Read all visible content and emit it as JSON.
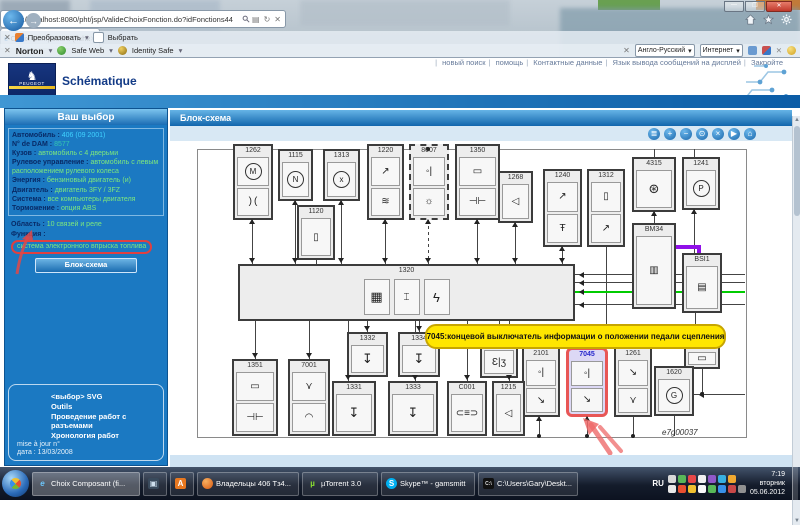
{
  "browser": {
    "url": "http://localhost:8080/pht/jsp/ValideChoixFonction.do?idFonctions44",
    "tab_title": "Choix Composant (fichier)",
    "command_bar": {
      "convert_label": "Преобразовать",
      "select_label": "Выбрать"
    },
    "norton": {
      "brand": "Norton",
      "safe_web": "Safe Web",
      "identity_safe": "Identity Safe"
    },
    "lang_dropdown": "Англо-Русский",
    "zone_dropdown": "Интернет"
  },
  "page": {
    "nav_links": [
      "новый поиск",
      "помощь",
      "Контактные данные",
      "Язык вывода сообщений на дисплей",
      "Закройте"
    ],
    "brand": {
      "logo_text": "PEUGEOT",
      "app_title": "Schématique"
    },
    "sidebar": {
      "title": "Ваш выбор",
      "vehicle": [
        {
          "label": "Автомобиль",
          "value": "406 (09 2001)",
          "color": "#3fd2ff"
        },
        {
          "label": "N° de DAM",
          "value": "8577",
          "color": "#35c8b0"
        },
        {
          "label": "Кузов",
          "value": "автомобиль с 4 дверьми"
        },
        {
          "label": "Рулевое управление",
          "value": "автомобиль с левым расположением рулевого колеса"
        },
        {
          "label": "Энергия",
          "value": "бензиновый двигатель (и)"
        },
        {
          "label": "Двигатель",
          "value": "двигатель 3FY / 3FZ"
        },
        {
          "label": "Система",
          "value": "все компьютеры двигателя"
        },
        {
          "label": "Торможение",
          "value": "опция ABS"
        }
      ],
      "selection": [
        {
          "label": "Область",
          "value": "10 связей и реле"
        },
        {
          "label": "Функция",
          "value": "система электронного впрыска топлива",
          "highlighted": true
        }
      ],
      "button": "Блок-схема",
      "footer_links": [
        "<выбор> SVG",
        "Outils",
        "Проведение работ с разъемами",
        "Хронология работ"
      ],
      "footer_meta": [
        "mise à jour n°",
        "дата : 13/03/2008"
      ]
    },
    "main": {
      "header": "Блок-схема",
      "toolbar_icons": [
        "print",
        "zoom-in",
        "zoom-out",
        "magnifier",
        "close",
        "play",
        "home"
      ],
      "diagram": {
        "ref": "e7g00037",
        "tooltip": "7045:концевой выключатель информации о положении педали сцепления",
        "accent_colors": {
          "highlight_border": "#e85656",
          "tooltip_bg": "#ffe600",
          "green_wire": "#00cc00",
          "purple_wire": "#9010e8"
        },
        "frame": {
          "x": 27,
          "y": 8,
          "w": 548,
          "h": 287
        },
        "boxes": [
          {
            "id": "1262",
            "x": 63,
            "y": 3,
            "w": 40,
            "h": 76,
            "cells": [
              "motor",
              "throttle"
            ]
          },
          {
            "id": "1115",
            "x": 108,
            "y": 8,
            "w": 35,
            "h": 52,
            "cells": [
              "circleN"
            ]
          },
          {
            "id": "1313",
            "x": 153,
            "y": 8,
            "w": 37,
            "h": 52,
            "cells": [
              "circleX"
            ]
          },
          {
            "id": "1120",
            "x": 127,
            "y": 64,
            "w": 38,
            "h": 55,
            "cells": [
              "piston"
            ]
          },
          {
            "id": "1220",
            "x": 197,
            "y": 3,
            "w": 37,
            "h": 76,
            "cells": [
              "flap",
              "temp"
            ]
          },
          {
            "id": "8007",
            "x": 239,
            "y": 3,
            "w": 40,
            "h": 76,
            "cells": [
              "contact",
              "sun"
            ],
            "dashed": true
          },
          {
            "id": "1350",
            "x": 285,
            "y": 3,
            "w": 45,
            "h": 76,
            "cells": [
              "resistor",
              "capacitor"
            ]
          },
          {
            "id": "1268",
            "x": 328,
            "y": 30,
            "w": 35,
            "h": 52,
            "cells": [
              "diode"
            ]
          },
          {
            "id": "1240",
            "x": 373,
            "y": 28,
            "w": 39,
            "h": 78,
            "cells": [
              "flap",
              "tempkey"
            ]
          },
          {
            "id": "1312",
            "x": 417,
            "y": 28,
            "w": 38,
            "h": 78,
            "cells": [
              "piston",
              "flap"
            ]
          },
          {
            "id": "4315",
            "x": 462,
            "y": 16,
            "w": 44,
            "h": 55,
            "cells": [
              "fan"
            ]
          },
          {
            "id": "1241",
            "x": 512,
            "y": 16,
            "w": 38,
            "h": 53,
            "cells": [
              "circleP"
            ]
          },
          {
            "id": "BM34",
            "x": 462,
            "y": 82,
            "w": 44,
            "h": 86,
            "cells": [
              "ecu"
            ]
          },
          {
            "id": "BSI1",
            "x": 512,
            "y": 112,
            "w": 40,
            "h": 60,
            "cells": [
              "ecu2"
            ]
          },
          {
            "id": "1273",
            "x": 514,
            "y": 198,
            "w": 36,
            "h": 30,
            "cells": [
              "mini"
            ]
          },
          {
            "id": "1320",
            "x": 68,
            "y": 123,
            "w": 337,
            "h": 57,
            "cells": [
              "chip",
              "spark",
              "lightning"
            ],
            "wide": true
          },
          {
            "id": "1332",
            "x": 177,
            "y": 191,
            "w": 41,
            "h": 45,
            "cells": [
              "injector"
            ]
          },
          {
            "id": "1334",
            "x": 228,
            "y": 191,
            "w": 42,
            "h": 45,
            "cells": [
              "injector"
            ]
          },
          {
            "id": "coil",
            "x": 310,
            "y": 205,
            "w": 38,
            "h": 32,
            "cells": [
              "coil"
            ],
            "nolabel": true
          },
          {
            "id": "2101",
            "x": 352,
            "y": 206,
            "w": 38,
            "h": 70,
            "cells": [
              "contact",
              "switch"
            ]
          },
          {
            "id": "7045",
            "x": 396,
            "y": 206,
            "w": 42,
            "h": 70,
            "cells": [
              "contact",
              "switch"
            ],
            "hl": true
          },
          {
            "id": "1261",
            "x": 444,
            "y": 206,
            "w": 38,
            "h": 70,
            "cells": [
              "switch",
              "wye"
            ]
          },
          {
            "id": "1620",
            "x": 484,
            "y": 225,
            "w": 40,
            "h": 50,
            "cells": [
              "circleG"
            ]
          },
          {
            "id": "1351",
            "x": 62,
            "y": 218,
            "w": 46,
            "h": 77,
            "cells": [
              "resistor",
              "capacitor"
            ]
          },
          {
            "id": "7001",
            "x": 118,
            "y": 218,
            "w": 42,
            "h": 77,
            "cells": [
              "wye",
              "gauge"
            ]
          },
          {
            "id": "1331",
            "x": 162,
            "y": 240,
            "w": 44,
            "h": 55,
            "cells": [
              "injector"
            ]
          },
          {
            "id": "1333",
            "x": 218,
            "y": 240,
            "w": 50,
            "h": 55,
            "cells": [
              "injector"
            ]
          },
          {
            "id": "C001",
            "x": 277,
            "y": 240,
            "w": 40,
            "h": 55,
            "cells": [
              "connector"
            ]
          },
          {
            "id": "1215",
            "x": 322,
            "y": 240,
            "w": 33,
            "h": 55,
            "cells": [
              "diode"
            ]
          }
        ],
        "lines": [
          {
            "x": 82,
            "y": 79,
            "h": 44
          },
          {
            "x": 125,
            "y": 60,
            "h": 63
          },
          {
            "x": 171,
            "y": 60,
            "h": 63
          },
          {
            "x": 146,
            "y": 119,
            "h": 4
          },
          {
            "x": 215,
            "y": 79,
            "h": 44
          },
          {
            "x": 258,
            "y": 79,
            "h": 44,
            "dash": true
          },
          {
            "x": 307,
            "y": 79,
            "h": 44
          },
          {
            "x": 345,
            "y": 82,
            "h": 41
          },
          {
            "x": 392,
            "y": 106,
            "h": 17
          },
          {
            "x": 436,
            "y": 106,
            "h": 84
          },
          {
            "x": 85,
            "y": 180,
            "h": 38
          },
          {
            "x": 139,
            "y": 180,
            "h": 38
          },
          {
            "x": 178,
            "y": 180,
            "h": 60
          },
          {
            "x": 197,
            "y": 180,
            "h": 11
          },
          {
            "x": 245,
            "y": 180,
            "h": 60
          },
          {
            "x": 249,
            "y": 180,
            "h": 11
          },
          {
            "x": 297,
            "y": 180,
            "h": 60
          },
          {
            "x": 339,
            "y": 180,
            "h": 60
          },
          {
            "x": 329,
            "y": 180,
            "h": 25
          },
          {
            "x": 484,
            "y": 71,
            "h": 11
          },
          {
            "x": 524,
            "y": 69,
            "h": 43
          },
          {
            "x": 525,
            "y": 172,
            "h": 26
          },
          {
            "x": 405,
            "y": 133,
            "w": 170
          },
          {
            "x": 405,
            "y": 141,
            "w": 170
          },
          {
            "x": 405,
            "y": 150,
            "w": 170,
            "color": "#00cc00",
            "th": 2
          },
          {
            "x": 405,
            "y": 163,
            "w": 170
          },
          {
            "x": 506,
            "y": 104,
            "w": 24,
            "color": "#9010e8",
            "th": 4
          },
          {
            "x": 527,
            "y": 104,
            "h": 10,
            "color": "#9010e8",
            "th": 4
          },
          {
            "x": 369,
            "y": 276,
            "h": 19
          },
          {
            "x": 417,
            "y": 276,
            "h": 19
          },
          {
            "x": 463,
            "y": 276,
            "h": 19
          },
          {
            "x": 504,
            "y": 275,
            "h": 20
          },
          {
            "x": 524,
            "y": 253,
            "w": 51
          },
          {
            "x": 532,
            "y": 228,
            "h": 25
          },
          {
            "x": 484,
            "y": 8,
            "h": 8
          },
          {
            "x": 524,
            "y": 8,
            "h": 8
          }
        ],
        "arrows": [
          {
            "d": "down",
            "x": 82,
            "y": 117
          },
          {
            "d": "down",
            "x": 125,
            "y": 117
          },
          {
            "d": "down",
            "x": 171,
            "y": 117
          },
          {
            "d": "down",
            "x": 215,
            "y": 117
          },
          {
            "d": "down",
            "x": 258,
            "y": 117
          },
          {
            "d": "down",
            "x": 307,
            "y": 117
          },
          {
            "d": "down",
            "x": 345,
            "y": 117
          },
          {
            "d": "down",
            "x": 392,
            "y": 117
          },
          {
            "d": "up",
            "x": 82,
            "y": 80
          },
          {
            "d": "up",
            "x": 125,
            "y": 61
          },
          {
            "d": "up",
            "x": 171,
            "y": 61
          },
          {
            "d": "up",
            "x": 215,
            "y": 80
          },
          {
            "d": "up",
            "x": 258,
            "y": 80
          },
          {
            "d": "up",
            "x": 307,
            "y": 80
          },
          {
            "d": "up",
            "x": 345,
            "y": 83
          },
          {
            "d": "up",
            "x": 392,
            "y": 107
          },
          {
            "d": "down",
            "x": 85,
            "y": 212
          },
          {
            "d": "down",
            "x": 139,
            "y": 212
          },
          {
            "d": "down",
            "x": 178,
            "y": 234
          },
          {
            "d": "down",
            "x": 197,
            "y": 185
          },
          {
            "d": "down",
            "x": 245,
            "y": 234
          },
          {
            "d": "down",
            "x": 249,
            "y": 185
          },
          {
            "d": "down",
            "x": 297,
            "y": 234
          },
          {
            "d": "down",
            "x": 339,
            "y": 234
          },
          {
            "d": "down",
            "x": 329,
            "y": 199
          },
          {
            "d": "up",
            "x": 484,
            "y": 72
          },
          {
            "d": "up",
            "x": 524,
            "y": 70
          },
          {
            "d": "up",
            "x": 369,
            "y": 277
          },
          {
            "d": "up",
            "x": 417,
            "y": 277
          },
          {
            "d": "down",
            "x": 525,
            "y": 192
          },
          {
            "d": "left",
            "x": 406,
            "y": 131
          },
          {
            "d": "left",
            "x": 406,
            "y": 139
          },
          {
            "d": "left",
            "x": 406,
            "y": 148
          },
          {
            "d": "left",
            "x": 406,
            "y": 161
          },
          {
            "d": "left",
            "x": 526,
            "y": 251
          }
        ],
        "dots": [
          {
            "x": 369,
            "y": 295
          },
          {
            "x": 417,
            "y": 295
          },
          {
            "x": 463,
            "y": 295
          },
          {
            "x": 532,
            "y": 253
          },
          {
            "x": 258,
            "y": 8
          }
        ]
      }
    }
  },
  "taskbar": {
    "buttons": [
      {
        "label": "Choix Composant (fi...",
        "icon": "ie",
        "active": true,
        "w": 108
      },
      {
        "label": "",
        "icon": "app",
        "w": 24
      },
      {
        "label": "",
        "icon": "abbyy",
        "w": 24
      },
      {
        "label": "Владельцы 406 Тз4...",
        "icon": "firefox",
        "w": 102
      },
      {
        "label": "µTorrent 3.0",
        "icon": "utorrent",
        "w": 76
      },
      {
        "label": "Skype™ - gamsmitt",
        "icon": "skype",
        "w": 94
      },
      {
        "label": "C:\\Users\\Gary\\Deskt...",
        "icon": "cmd",
        "w": 100
      }
    ],
    "tray": {
      "lang": "RU",
      "icon_colors_row1": [
        "#d8d8d8",
        "#58b858",
        "#e84848",
        "#f0f0f0",
        "#9058c8",
        "#38b0e0",
        "#f0a830"
      ],
      "icon_colors_row2": [
        "#e8e8e8",
        "#e85030",
        "#f0c030",
        "#f8f8f8",
        "#58b858",
        "#3890e8",
        "#c84848",
        "#909090"
      ],
      "clock": {
        "time": "7:19",
        "day": "вторник",
        "date": "05.06.2012"
      }
    }
  }
}
